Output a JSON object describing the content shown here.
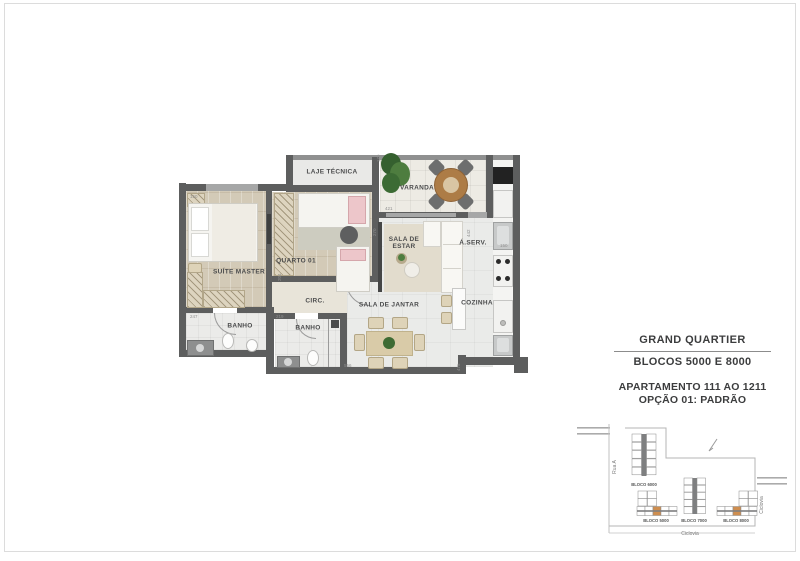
{
  "info_panel": {
    "title": "GRAND QUARTIER",
    "blocks_line": "BLOCOS 5000 E 8000",
    "apartment_line": "APARTAMENTO 111 AO 1211",
    "option_line": "OPÇÃO 01: PADRÃO"
  },
  "floorplan": {
    "rooms": {
      "laje_tecnica": "LAJE TÉCNICA",
      "varanda": "VARANDA",
      "suite_master": "SUÍTE MASTER",
      "quarto_01": "QUARTO 01",
      "sala_de_estar": "SALA DE ESTAR",
      "sala_de_jantar": "SALA DE JANTAR",
      "circulacao": "CIRC.",
      "banho_suite": "BANHO",
      "banho_social": "BANHO",
      "area_servico": "Á.SERV.",
      "cozinha": "COZINHA"
    },
    "dimensions": {
      "d1": "150",
      "d2": "179",
      "d3": "421",
      "d4": "270",
      "d5": "204",
      "d6": "247",
      "d7": "219",
      "d8": "556",
      "d9": "442",
      "d10": "150",
      "d11": "475"
    }
  },
  "site_plan": {
    "street_left": "Rua A",
    "cicloway_bottom": "Ciclovia",
    "cicloway_right": "Ciclovia",
    "blocks": [
      "BLOCO 6000",
      "BLOCO 5000",
      "BLOCO 7000",
      "BLOCO 8000"
    ],
    "highlight_color": "#cf8e4f"
  }
}
